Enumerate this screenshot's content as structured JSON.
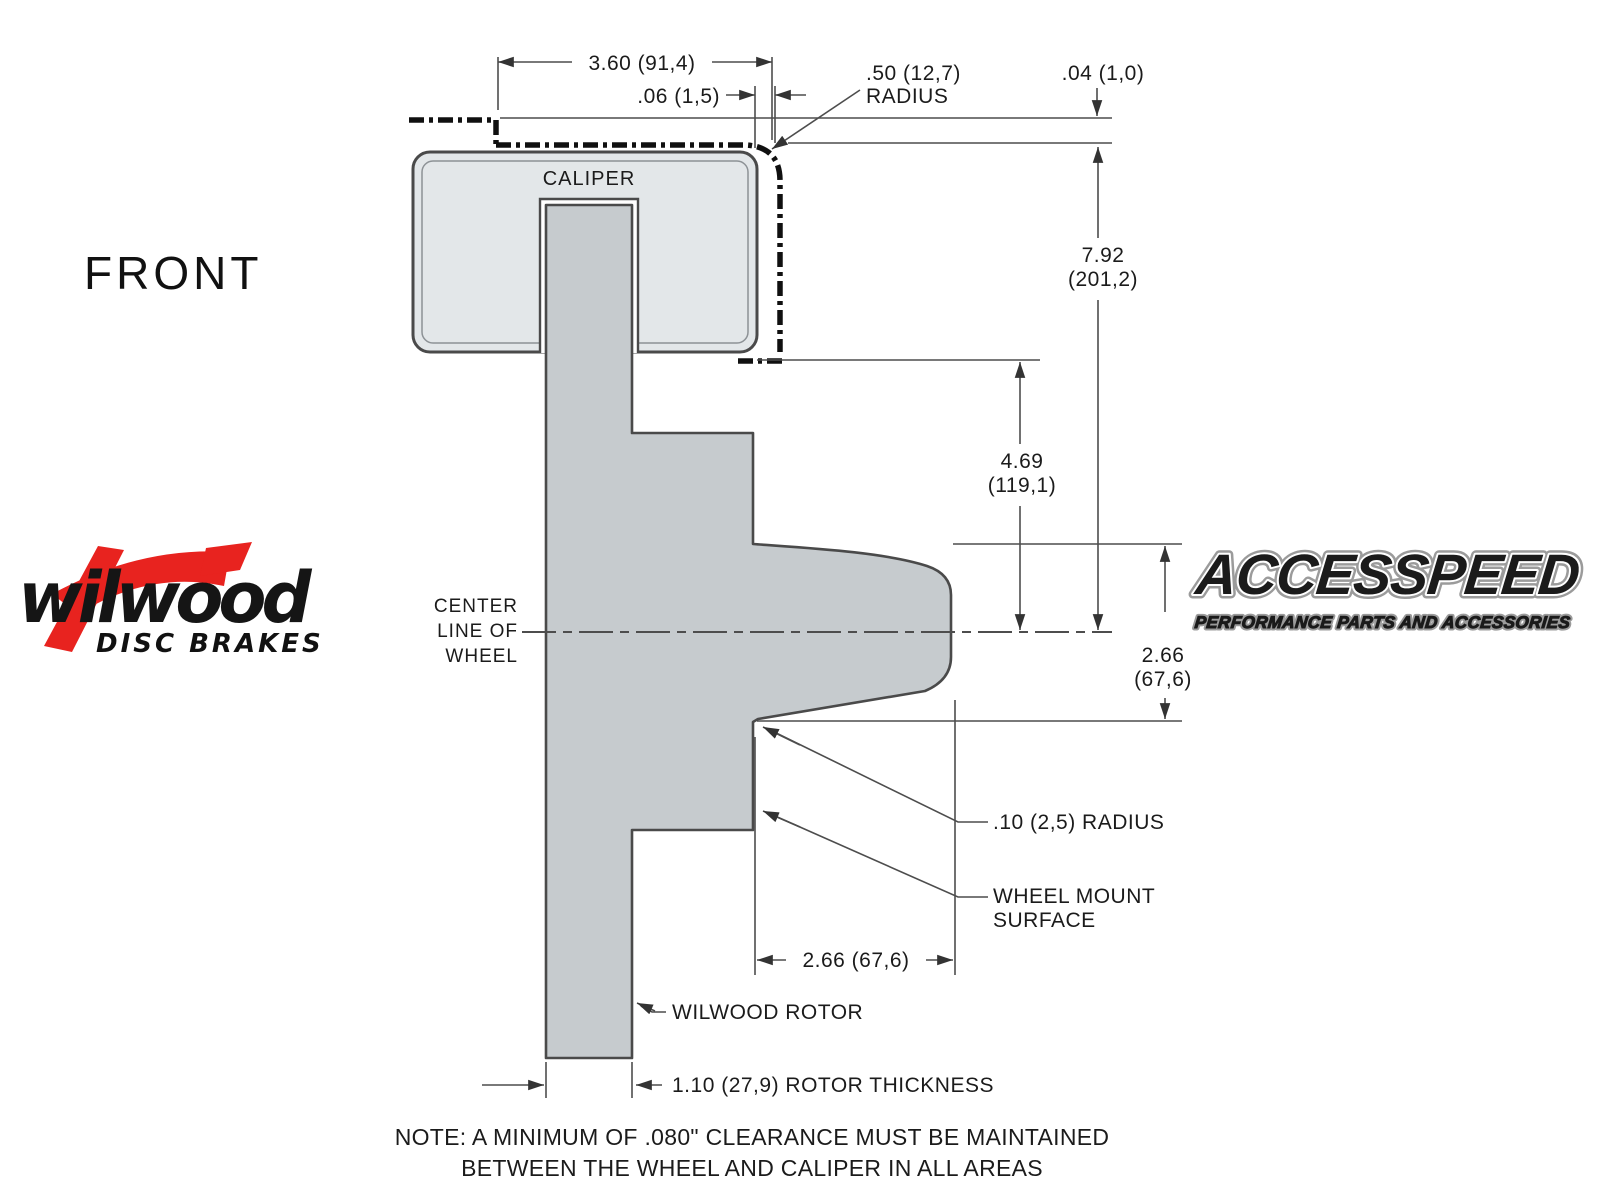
{
  "view_label": "FRONT",
  "caliper": {
    "label": "CALIPER"
  },
  "centerline": {
    "line1": "CENTER",
    "line2": "LINE OF",
    "line3": "WHEEL"
  },
  "dims": {
    "caliper_width": "3.60 (91,4)",
    "caliper_wheel_gap": ".06 (1,5)",
    "corner_radius_line1": ".50 (12,7)",
    "corner_radius_line2": "RADIUS",
    "wheel_clearance": ".04 (1,0)",
    "wheel_depth_line1": "7.92",
    "wheel_depth_line2": "(201,2)",
    "caliper_depth_line1": "4.69",
    "caliper_depth_line2": "(119,1)",
    "hat_depth_line1": "2.66",
    "hat_depth_line2": "(67,6)",
    "fillet_radius": ".10 (2,5) RADIUS",
    "wheel_mount_line1": "WHEEL MOUNT",
    "wheel_mount_line2": "SURFACE",
    "mount_offset": "2.66 (67,6)",
    "rotor_callout": "WILWOOD ROTOR",
    "rotor_thickness": "1.10 (27,9) ROTOR THICKNESS"
  },
  "note": {
    "line1": "NOTE: A MINIMUM OF .080\" CLEARANCE MUST BE MAINTAINED",
    "line2": "BETWEEN THE WHEEL AND CALIPER IN ALL AREAS"
  },
  "wilwood_logo": {
    "brand": "wilwood",
    "tagline": "DISC BRAKES"
  },
  "accesspeed_logo": {
    "brand": "ACCESSPEED",
    "tagline": "PERFORMANCE PARTS AND ACCESSORIES"
  },
  "colors": {
    "rotor_fill": "#c6cbce",
    "caliper_fill": "#e3e7e9",
    "outline": "#4a4a4a",
    "dimension_lines": "#4d4d4d",
    "logo_red": "#e8231f",
    "background": "#ffffff"
  }
}
